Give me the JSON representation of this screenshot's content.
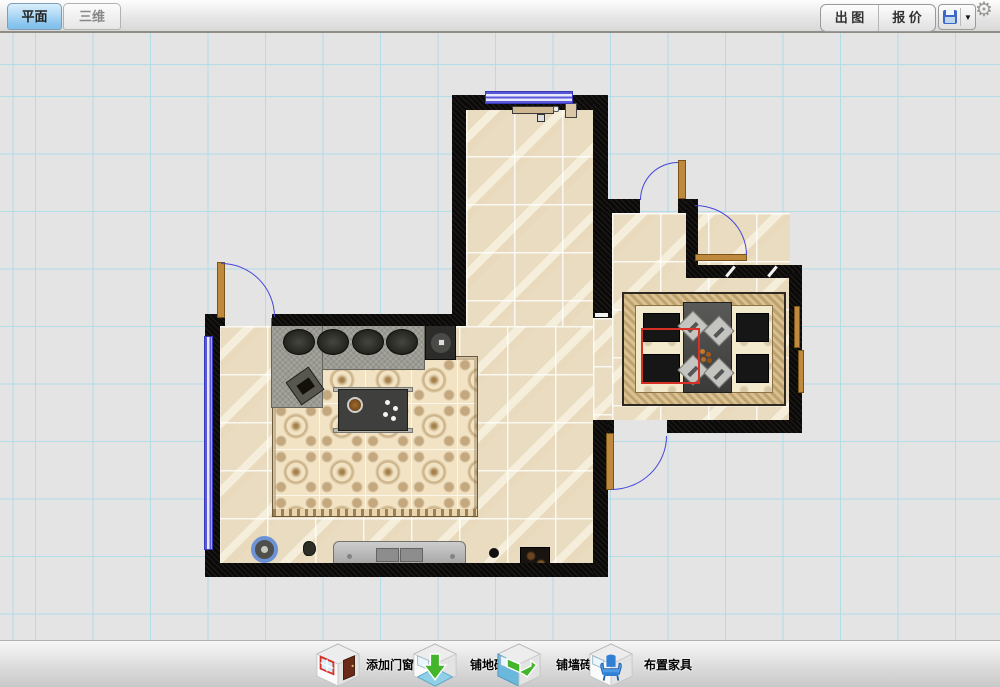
{
  "header": {
    "tabs": [
      {
        "label": "平面",
        "active": true
      },
      {
        "label": "三维",
        "active": false
      }
    ],
    "export_label": "出 图",
    "quote_label": "报 价",
    "save_icon": "floppy-disk-icon",
    "save_caret": "▼",
    "settings_icon": "gear-icon",
    "settings_glyph": "⚙"
  },
  "bottom_toolbar": {
    "items": [
      {
        "label": "添加门窗",
        "icon": "add-door-window-icon"
      },
      {
        "label": "铺地砖",
        "icon": "lay-floor-tile-icon"
      },
      {
        "label": "铺墙砖",
        "icon": "lay-wall-tile-icon"
      },
      {
        "label": "布置家具",
        "icon": "arrange-furniture-icon"
      }
    ]
  },
  "canvas": {
    "grid_color": "#b2dde8",
    "background_color": "#e4e4e4",
    "wall_color": "#0b0a08",
    "floor_tile_color": "#e9dcc0",
    "door_leaf_color": "#c08a3e",
    "door_arc_color": "#4444dd",
    "window_color": "#5858d8",
    "selection_color": "#d93025",
    "elements": [
      "corridor",
      "living-room",
      "dining-room",
      "sofa",
      "coffee-table",
      "tv-stand",
      "dining-table",
      "chairs",
      "doors",
      "windows",
      "rug",
      "dining-carpet"
    ]
  }
}
